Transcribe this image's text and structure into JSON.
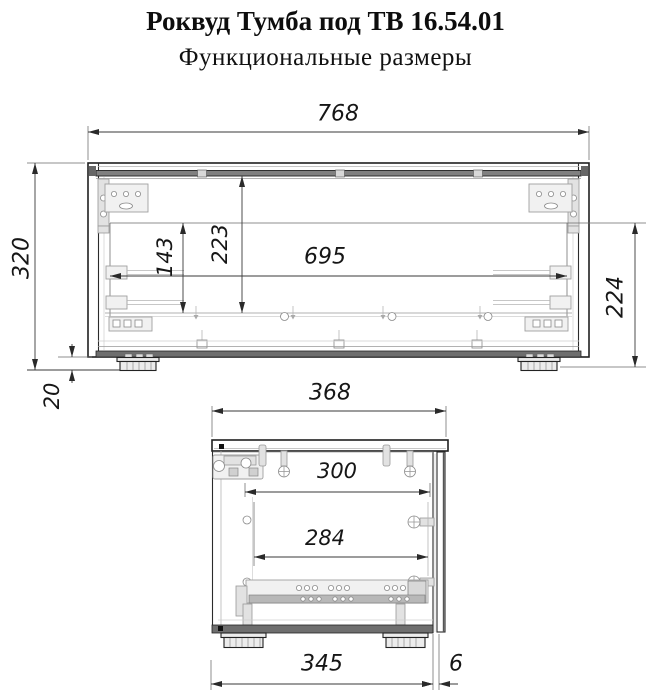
{
  "header": {
    "title": "Роквуд Тумба под ТВ 16.54.01",
    "subtitle": "Функциональные размеры"
  },
  "front_view": {
    "dims": {
      "overall_width": "768",
      "overall_height": "320",
      "plinth_height": "20",
      "niche_width": "695",
      "niche_height_right": "224",
      "inner_height": "223",
      "inner_height_small": "143"
    }
  },
  "side_view": {
    "dims": {
      "overall_depth": "368",
      "inner_depth": "300",
      "inner_depth_lower": "284",
      "base_depth": "345",
      "door_offset": "6"
    }
  },
  "colors": {
    "line_dark": "#1f1f1f",
    "line_light": "#b5b5b5",
    "panel_band": "#6e6e6e",
    "background": "#ffffff"
  }
}
